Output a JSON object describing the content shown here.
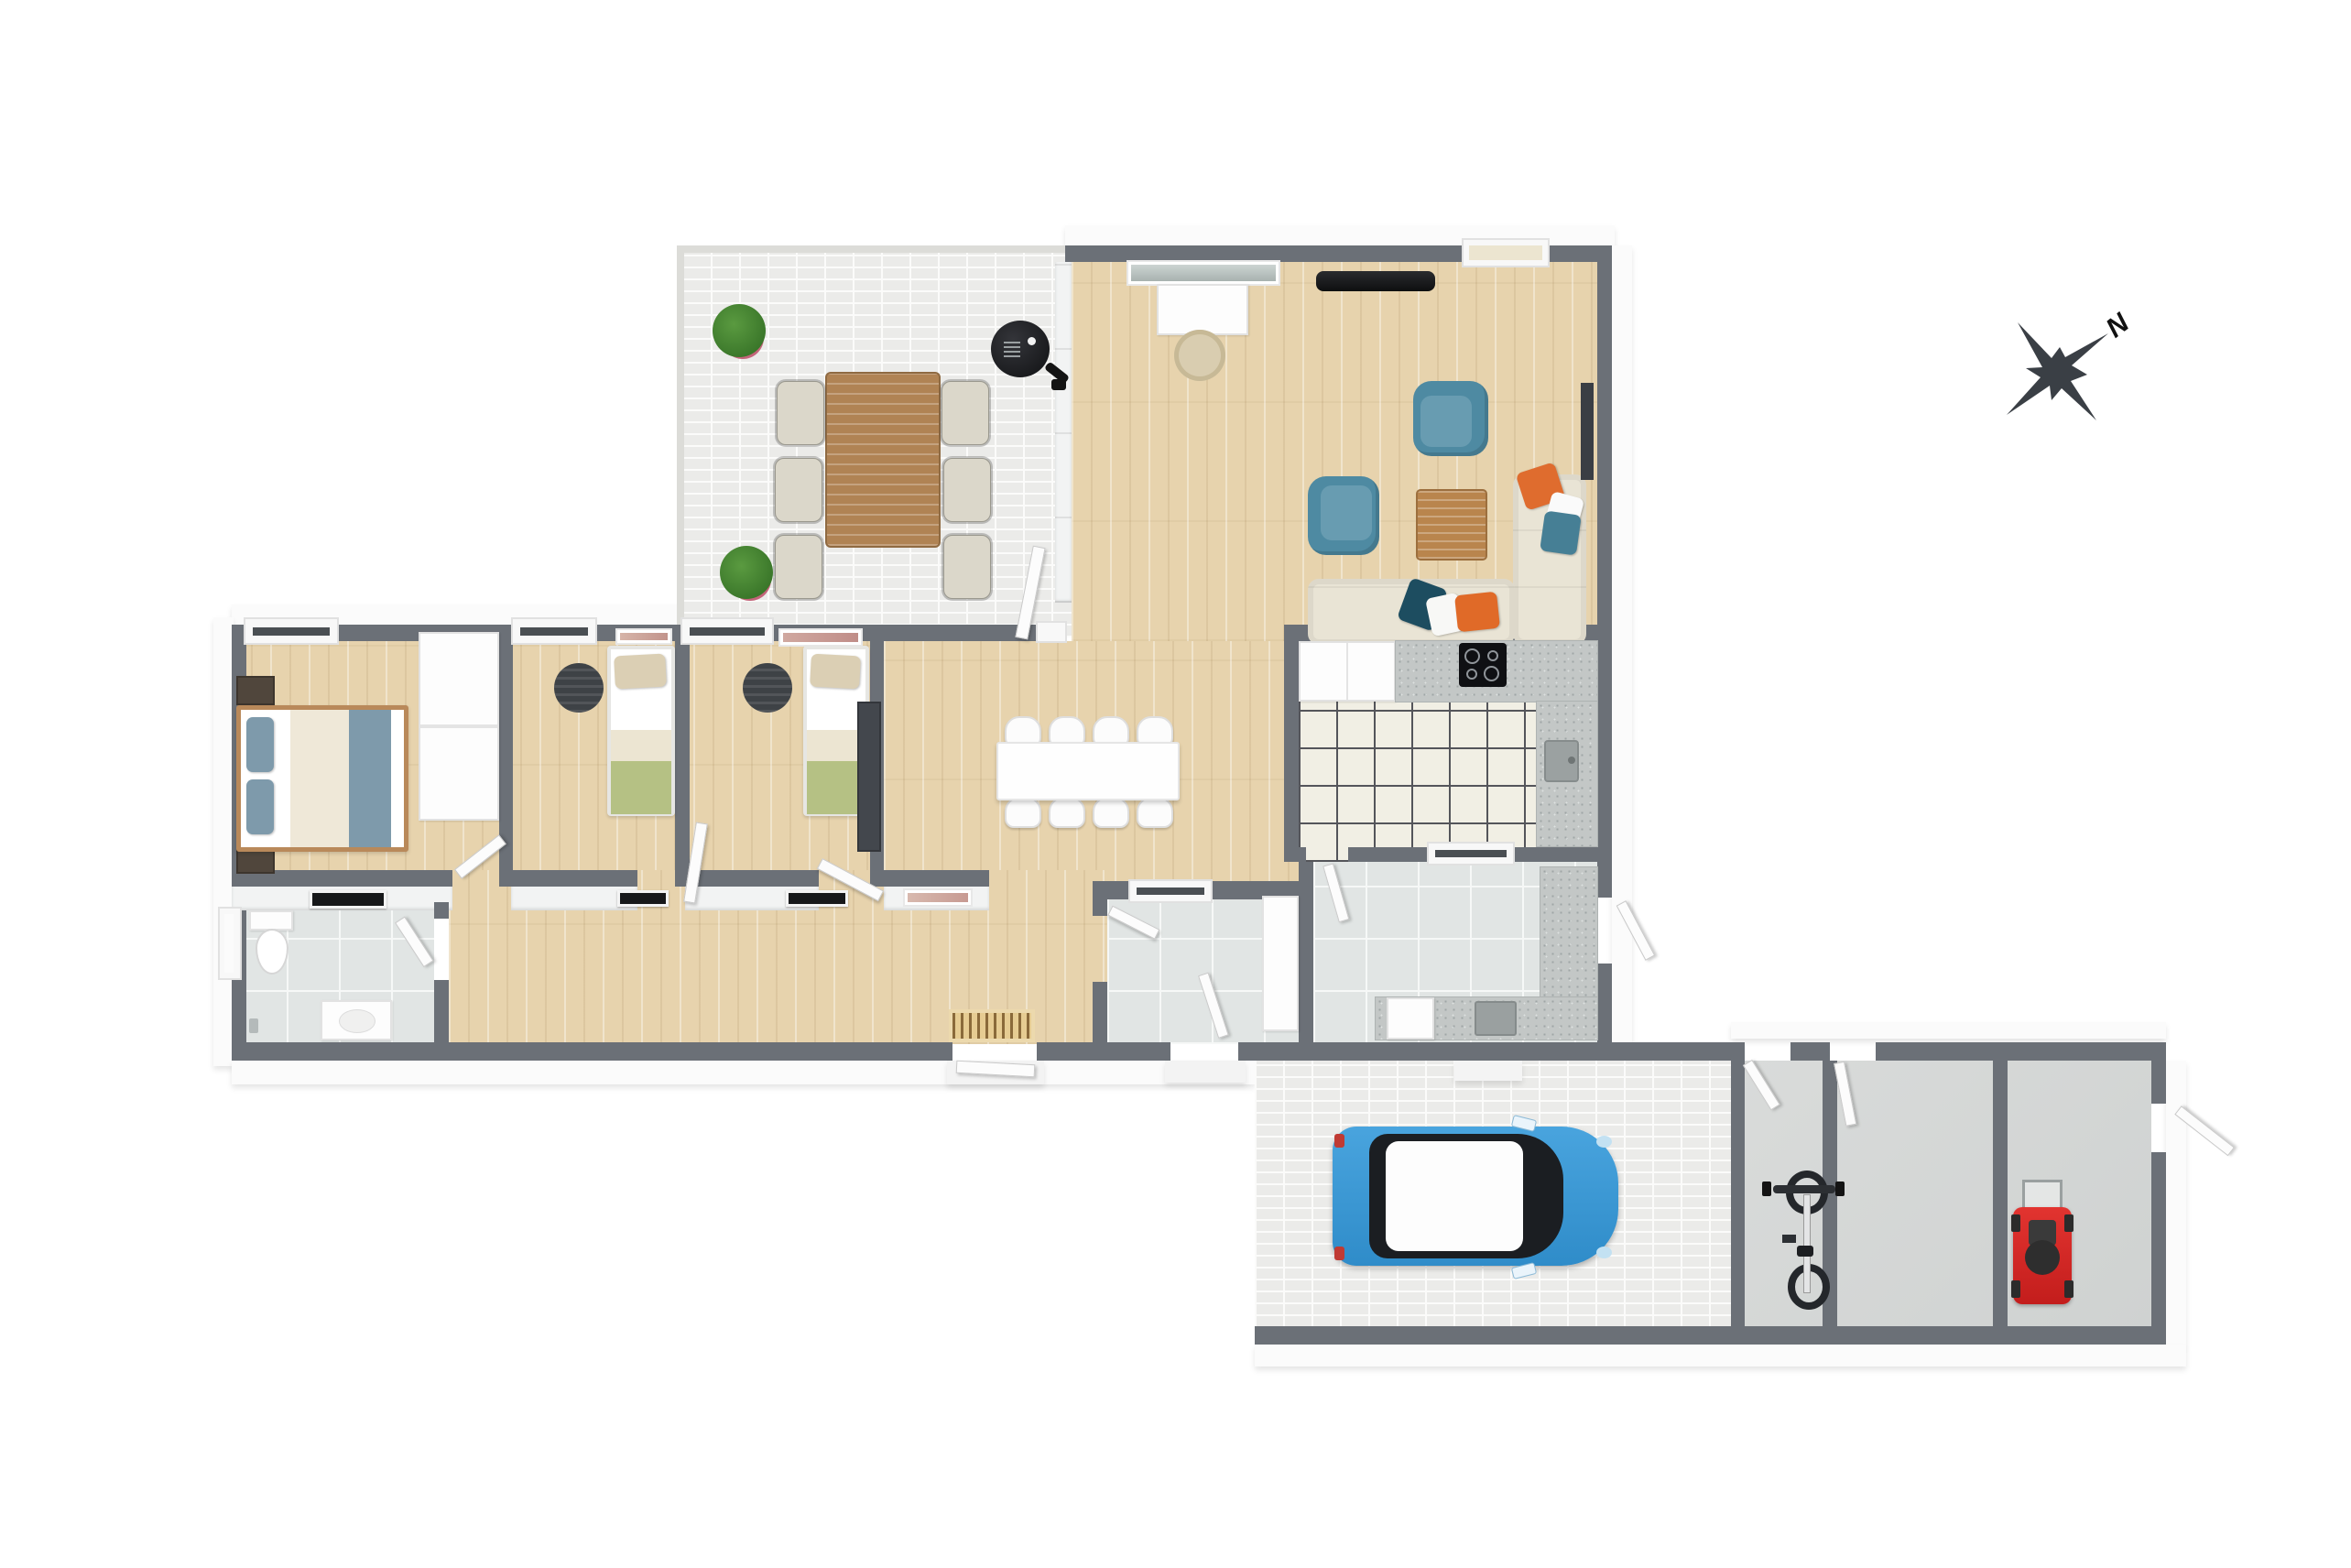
{
  "title": "3d-floor-plan",
  "compass": {
    "label": "N"
  },
  "palette": {
    "wall_gray": "#6b7077",
    "wood_floor": "#e7d3ad",
    "brick_paver": "#ebebe9",
    "kitchen_tile": "#f1efe4",
    "bath_tile": "#e1e5e4",
    "concrete": "#d9dbda",
    "accent_teal": "#4e8aa2",
    "accent_orange": "#df6c2e",
    "sofa_cream": "#e9e4d5",
    "bed_blue": "#7e9aab",
    "blanket_green": "#b5c184",
    "car_blue": "#3b99d9",
    "mower_red": "#d62322",
    "plant_green": "#3c7c2b",
    "table_wood": "#b08354"
  },
  "rooms": [
    {
      "id": "terrace",
      "name": "terrace",
      "floor": "brick-pavers",
      "items": [
        "potted-plant",
        "potted-plant",
        "outdoor-dining-table",
        "six-outdoor-chairs",
        "kettle-grill"
      ]
    },
    {
      "id": "living-room",
      "name": "living-room",
      "floor": "wood",
      "items": [
        "wall-tv",
        "desk",
        "desk-chair",
        "wall-art",
        "armchair",
        "armchair",
        "coffee-table",
        "corner-sofa",
        "six-cushions",
        "wall-panel"
      ]
    },
    {
      "id": "dining-area",
      "name": "dining-area",
      "floor": "wood",
      "items": [
        "dining-table",
        "eight-dining-chairs",
        "wall-art"
      ]
    },
    {
      "id": "kitchen",
      "name": "kitchen",
      "floor": "tile",
      "items": [
        "white-cabinets",
        "granite-counter",
        "cooktop",
        "sink"
      ]
    },
    {
      "id": "utility-room",
      "name": "utility-room",
      "floor": "tile",
      "items": [
        "granite-counter",
        "washer",
        "sink",
        "tall-cabinet"
      ]
    },
    {
      "id": "rear-entry",
      "name": "rear-entry",
      "floor": "tile",
      "items": [
        "window",
        "exterior-door"
      ]
    },
    {
      "id": "master-bedroom",
      "name": "master-bedroom",
      "floor": "wood",
      "items": [
        "double-bed",
        "nightstand",
        "nightstand",
        "wardrobe",
        "window"
      ]
    },
    {
      "id": "bedroom-2",
      "name": "bedroom-2",
      "floor": "wood",
      "items": [
        "single-bed",
        "round-rug",
        "wall-art",
        "window"
      ]
    },
    {
      "id": "bedroom-3",
      "name": "bedroom-3",
      "floor": "wood",
      "items": [
        "single-bed",
        "round-rug",
        "dark-wardrobe",
        "wall-art",
        "window"
      ]
    },
    {
      "id": "bathroom",
      "name": "bathroom",
      "floor": "tile",
      "items": [
        "toilet",
        "vanity-sink",
        "faucet",
        "window"
      ]
    },
    {
      "id": "hallway",
      "name": "hallway",
      "floor": "wood",
      "items": [
        "slatted-doormat",
        "front-door"
      ]
    },
    {
      "id": "carport",
      "name": "carport",
      "floor": "brick-pavers",
      "items": [
        "blue-car"
      ]
    },
    {
      "id": "bike-storage",
      "name": "bike-storage",
      "floor": "concrete",
      "items": [
        "bicycle",
        "wall-hooks"
      ]
    },
    {
      "id": "storage-room",
      "name": "storage-room",
      "floor": "concrete",
      "items": []
    },
    {
      "id": "mower-storage",
      "name": "mower-storage",
      "floor": "concrete",
      "items": [
        "lawn-mower"
      ]
    }
  ]
}
